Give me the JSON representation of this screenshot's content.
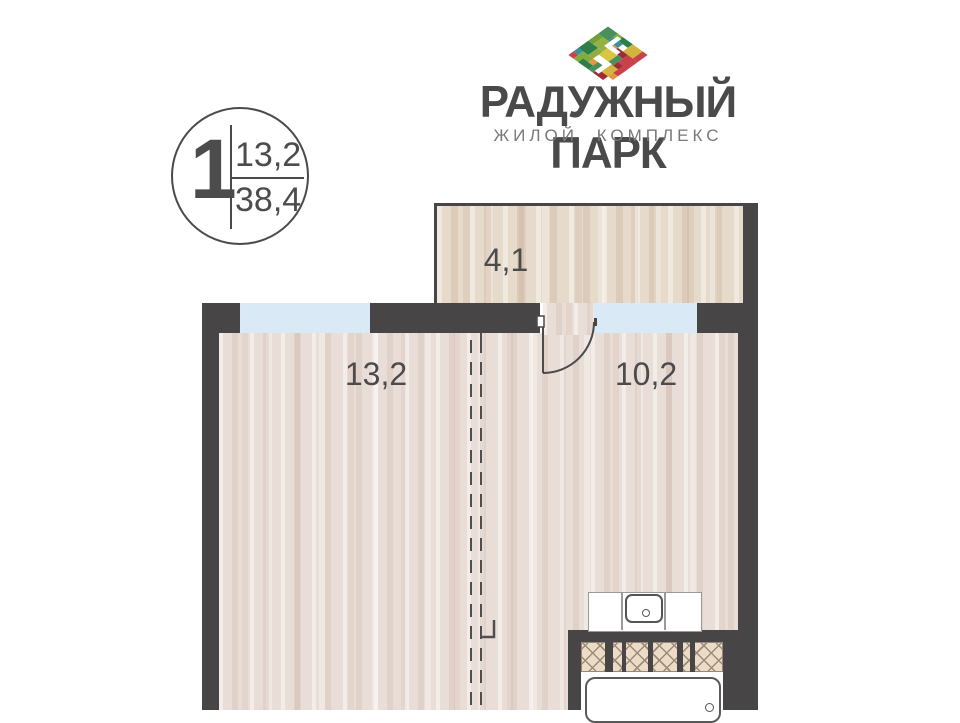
{
  "logo": {
    "title": "РАДУЖНЫЙ ПАРК",
    "subtitle": "ЖИЛОЙ КОМПЛЕКС",
    "mosaic_icon": "rainbow-mosaic-diamond",
    "title_color": "#4a4a4b",
    "subtitle_color": "#77787a",
    "mosaic_palette": [
      "#9e2b35",
      "#c8414b",
      "#e0993c",
      "#d9c53f",
      "#d2b63c",
      "#8fae3f",
      "#7fae3f",
      "#4b8f5a",
      "#2f7d4b",
      "#3f8e9e"
    ]
  },
  "unit_badge": {
    "rooms_count": "1",
    "living_area": "13,2",
    "total_area": "38,4"
  },
  "floor_plan": {
    "rooms": {
      "loggia": {
        "area": "4,1"
      },
      "living_room": {
        "area": "13,2"
      },
      "kitchen": {
        "area": "10,2"
      }
    },
    "colors": {
      "wall": "#474546",
      "window": "#d9eaf6",
      "floor_base": "#e9ded7",
      "loggia_floor_base": "#e6dacb",
      "hatch_fill": "#ecdcc6",
      "line": "#4b4b4b"
    }
  }
}
